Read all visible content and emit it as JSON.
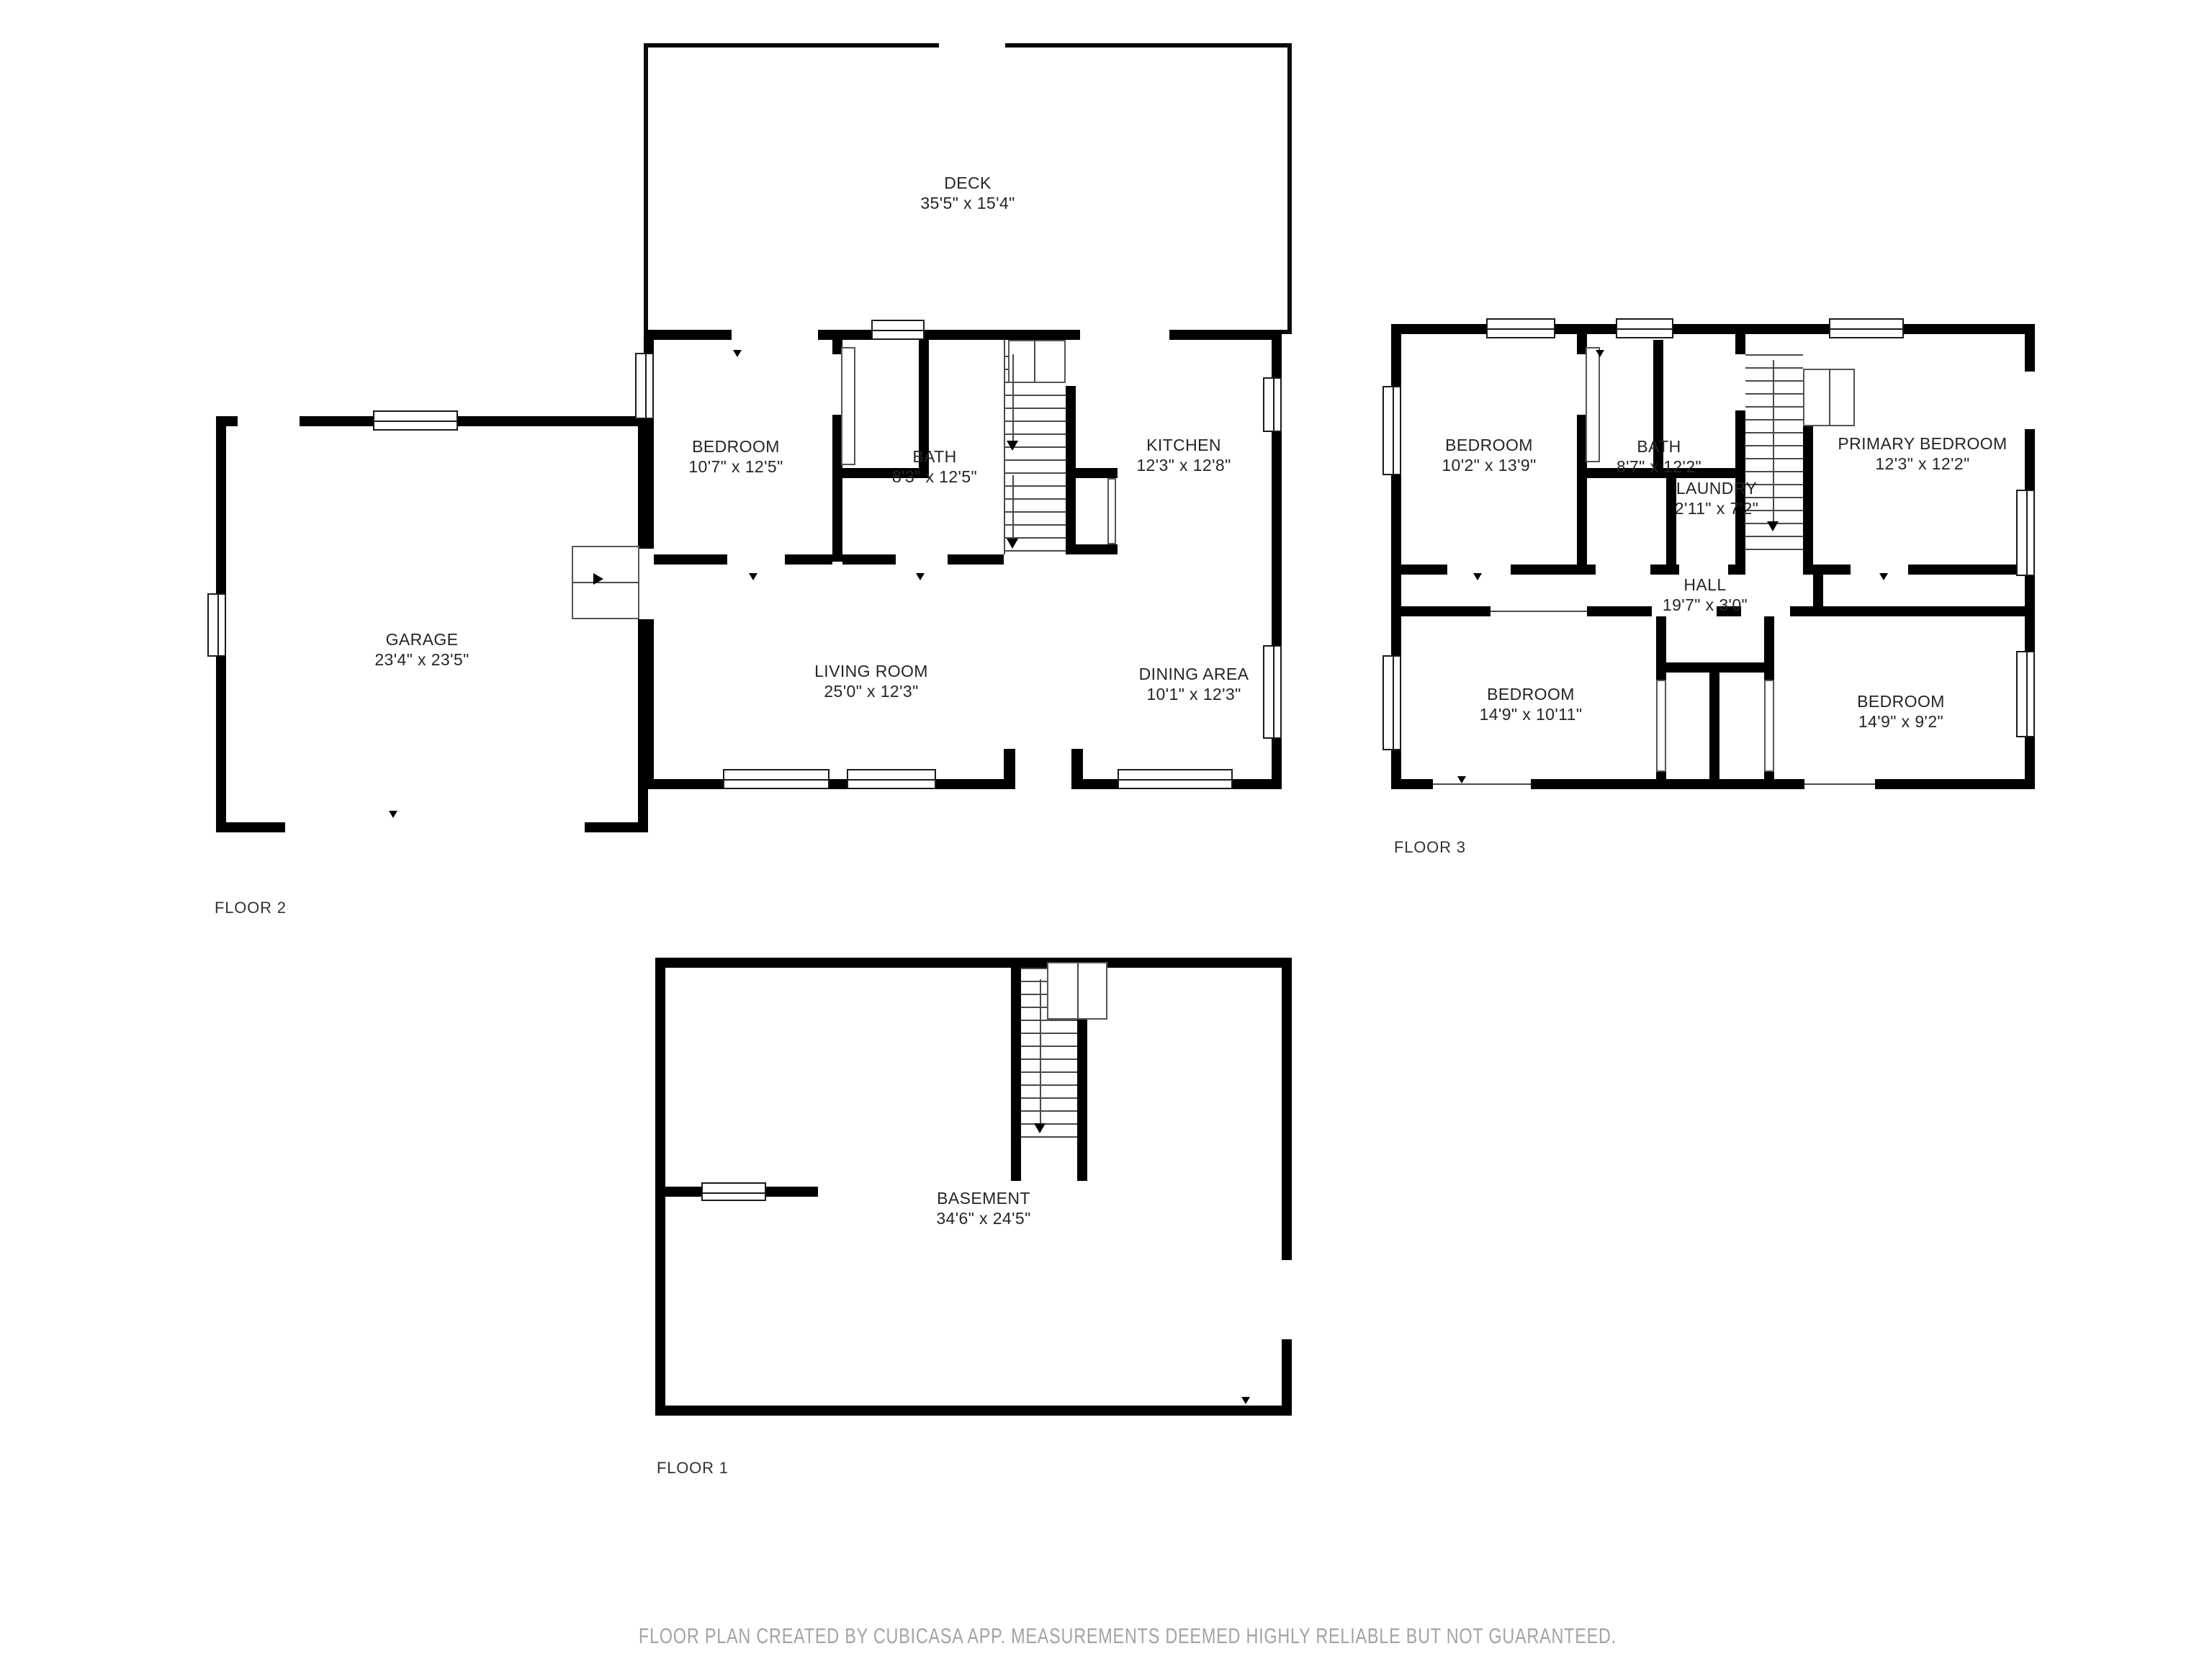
{
  "floors": [
    {
      "label": "FLOOR 2",
      "rooms": [
        {
          "name": "DECK",
          "dims": "35'5\" x 15'4\""
        },
        {
          "name": "BEDROOM",
          "dims": "10'7\" x 12'5\""
        },
        {
          "name": "BATH",
          "dims": "8'3\" x 12'5\""
        },
        {
          "name": "KITCHEN",
          "dims": "12'3\" x 12'8\""
        },
        {
          "name": "GARAGE",
          "dims": "23'4\" x 23'5\""
        },
        {
          "name": "LIVING ROOM",
          "dims": "25'0\" x 12'3\""
        },
        {
          "name": "DINING AREA",
          "dims": "10'1\" x 12'3\""
        }
      ]
    },
    {
      "label": "FLOOR 3",
      "rooms": [
        {
          "name": "BEDROOM",
          "dims": "10'2\" x 13'9\""
        },
        {
          "name": "BATH",
          "dims": "8'7\" x 12'2\""
        },
        {
          "name": "LAUNDRY",
          "dims": "2'11\" x 7'2\""
        },
        {
          "name": "PRIMARY BEDROOM",
          "dims": "12'3\" x 12'2\""
        },
        {
          "name": "HALL",
          "dims": "19'7\" x 3'0\""
        },
        {
          "name": "BEDROOM",
          "dims": "14'9\" x 10'11\""
        },
        {
          "name": "BEDROOM",
          "dims": "14'9\" x 9'2\""
        }
      ]
    },
    {
      "label": "FLOOR 1",
      "rooms": [
        {
          "name": "BASEMENT",
          "dims": "34'6\" x 24'5\""
        }
      ]
    }
  ],
  "footer": {
    "text": "FLOOR PLAN CREATED BY CUBICASA APP. MEASUREMENTS DEEMED HIGHLY RELIABLE BUT NOT GUARANTEED."
  },
  "colors": {
    "wall": "#000000",
    "label": "#252525",
    "footer": "#a3a3a3"
  }
}
